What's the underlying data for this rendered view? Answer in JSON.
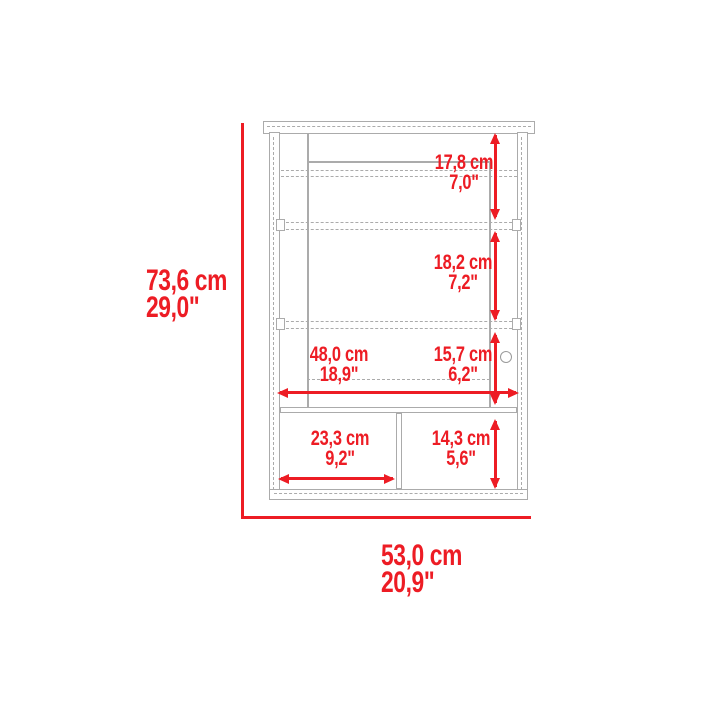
{
  "diagram": {
    "type": "furniture-dimension-diagram",
    "subject": "wall medicine cabinet with mirror door and lower open shelves"
  },
  "colors": {
    "accent_red": "#ed1c24",
    "line_gray": "#ababab",
    "background": "#ffffff"
  },
  "dimensions": {
    "overall_height": {
      "cm": "73,6 cm",
      "in": "29,0\""
    },
    "overall_width": {
      "cm": "53,0 cm",
      "in": "20,9\""
    },
    "top_section": {
      "cm": "17,8 cm",
      "in": "7,0\""
    },
    "middle_section": {
      "cm": "18,2 cm",
      "in": "7,2\""
    },
    "interior_width": {
      "cm": "48,0 cm",
      "in": "18,9\""
    },
    "lower_section": {
      "cm": "15,7 cm",
      "in": "6,2\""
    },
    "shelf_left_width": {
      "cm": "23,3 cm",
      "in": "9,2\""
    },
    "shelf_right_height": {
      "cm": "14,3 cm",
      "in": "5,6\""
    }
  }
}
